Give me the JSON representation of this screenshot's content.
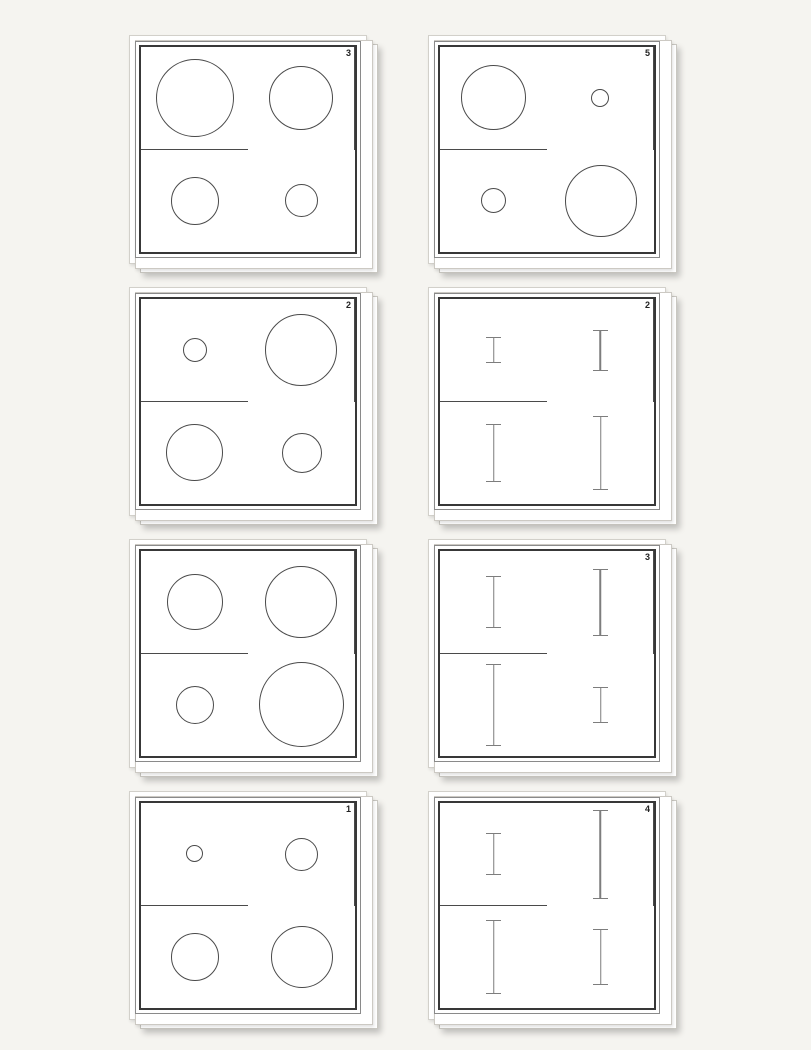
{
  "page": {
    "background_color": "#f5f4f0",
    "description": "Sheet of eight stimulus cards, each a 2x2 grid of outline shapes"
  },
  "colors": {
    "circle_stroke": "#4a4a4a",
    "ibeam_stroke": "#7d7d7d",
    "frame_thick": "#383838",
    "frame_thin": "#8a8a8a",
    "grid_line": "#4a4a4a",
    "number_color": "#222222"
  },
  "cards": [
    {
      "number": "3",
      "cells": [
        {
          "shape": "circle",
          "size": 78
        },
        {
          "shape": "circle",
          "size": 64
        },
        {
          "shape": "circle",
          "size": 48
        },
        {
          "shape": "circle",
          "size": 33
        }
      ]
    },
    {
      "number": "5",
      "cells": [
        {
          "shape": "circle",
          "size": 65
        },
        {
          "shape": "circle",
          "size": 18
        },
        {
          "shape": "circle",
          "size": 25
        },
        {
          "shape": "circle",
          "size": 72
        }
      ]
    },
    {
      "number": "2",
      "cells": [
        {
          "shape": "circle",
          "size": 24
        },
        {
          "shape": "circle",
          "size": 72
        },
        {
          "shape": "circle",
          "size": 57
        },
        {
          "shape": "circle",
          "size": 40
        }
      ]
    },
    {
      "number": "2",
      "cells": [
        {
          "shape": "ibeam",
          "size": 26
        },
        {
          "shape": "ibeam",
          "size": 41
        },
        {
          "shape": "ibeam",
          "size": 58
        },
        {
          "shape": "ibeam",
          "size": 74
        }
      ]
    },
    {
      "number": "",
      "cells": [
        {
          "shape": "circle",
          "size": 56
        },
        {
          "shape": "circle",
          "size": 72
        },
        {
          "shape": "circle",
          "size": 38
        },
        {
          "shape": "circle",
          "size": 85
        }
      ]
    },
    {
      "number": "3",
      "cells": [
        {
          "shape": "ibeam",
          "size": 52
        },
        {
          "shape": "ibeam",
          "size": 67
        },
        {
          "shape": "ibeam",
          "size": 82
        },
        {
          "shape": "ibeam",
          "size": 36
        }
      ]
    },
    {
      "number": "1",
      "cells": [
        {
          "shape": "circle",
          "size": 17
        },
        {
          "shape": "circle",
          "size": 33
        },
        {
          "shape": "circle",
          "size": 48
        },
        {
          "shape": "circle",
          "size": 62
        }
      ]
    },
    {
      "number": "4",
      "cells": [
        {
          "shape": "ibeam",
          "size": 42
        },
        {
          "shape": "ibeam",
          "size": 89
        },
        {
          "shape": "ibeam",
          "size": 74
        },
        {
          "shape": "ibeam",
          "size": 56
        }
      ]
    }
  ]
}
